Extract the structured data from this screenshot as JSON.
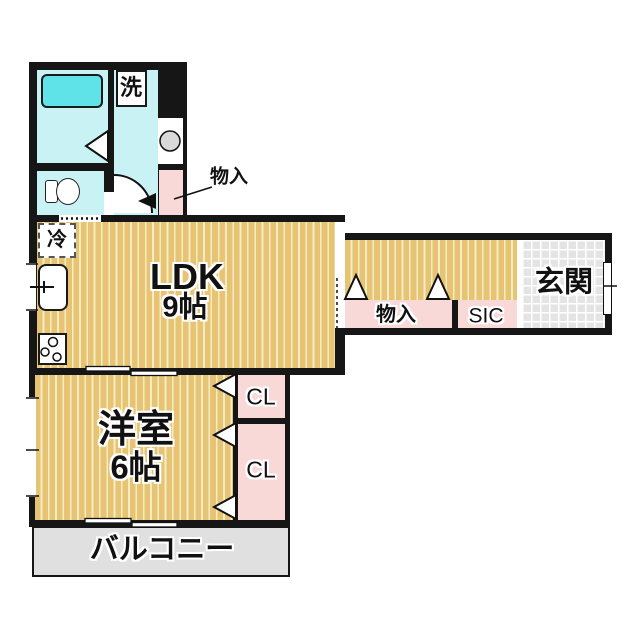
{
  "figure": "apartment-floor-plan",
  "colors": {
    "wall": "#161616",
    "floor-wood": "#e7c474",
    "floor-stripe": "#f6ecc4",
    "room-cyan": "#c9f2f4",
    "bathtub-cyan": "#5fe3e8",
    "closet-pink": "#f9d8d8",
    "tile-gray": "#e4e4e4",
    "balcony-gray": "#e0e0e0"
  },
  "labels": {
    "washer": "洗",
    "storage_upper": "物入",
    "fridge": "冷",
    "ldk_name": "LDK",
    "ldk_size": "9帖",
    "hall_storage": "物入",
    "shoe_closet": "SIC",
    "entrance": "玄関",
    "bedroom_name": "洋室",
    "bedroom_size": "6帖",
    "closet_top": "CL",
    "closet_bottom": "CL",
    "balcony": "バルコニー"
  }
}
